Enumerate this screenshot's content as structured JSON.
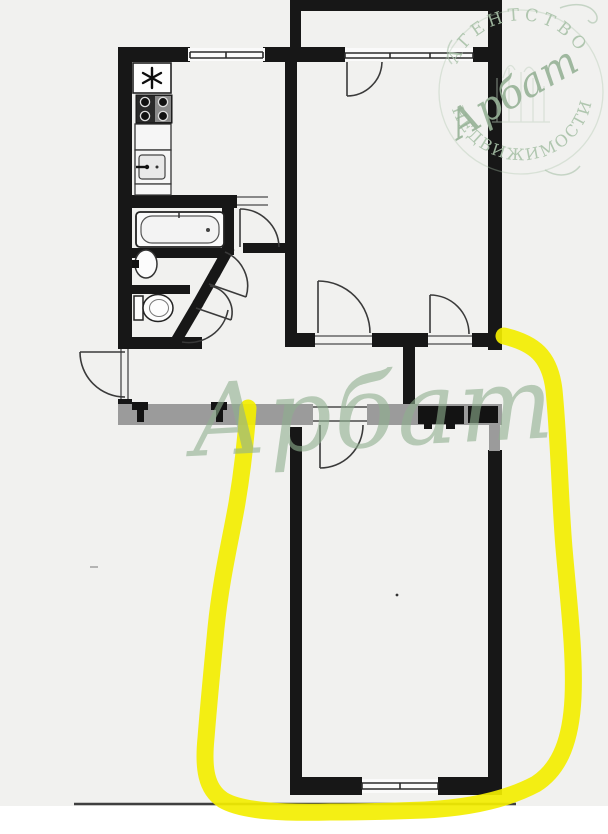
{
  "page": {
    "background": "#ffffff",
    "photo_background": "#f1f1ef"
  },
  "watermark": {
    "text": "Арбат",
    "color": "#8fb08f"
  },
  "logo": {
    "arc_top": "АГЕНТСТВО",
    "arc_bottom": "НЕДВИЖИМОСТИ",
    "script": "Арбат",
    "color": "#a9c2a9",
    "script_color": "#97b297"
  },
  "highlight": {
    "color": "#f3ee00"
  },
  "plan": {
    "wall_color": "#171717",
    "slab_color": "#9b9b9b",
    "door_line_color": "#3a3a3a",
    "fixtures": [
      "fridge",
      "stove",
      "kitchen-sink",
      "bathtub",
      "washbasin",
      "toilet"
    ],
    "snowflake_symbol": "fridge-snowflake"
  }
}
